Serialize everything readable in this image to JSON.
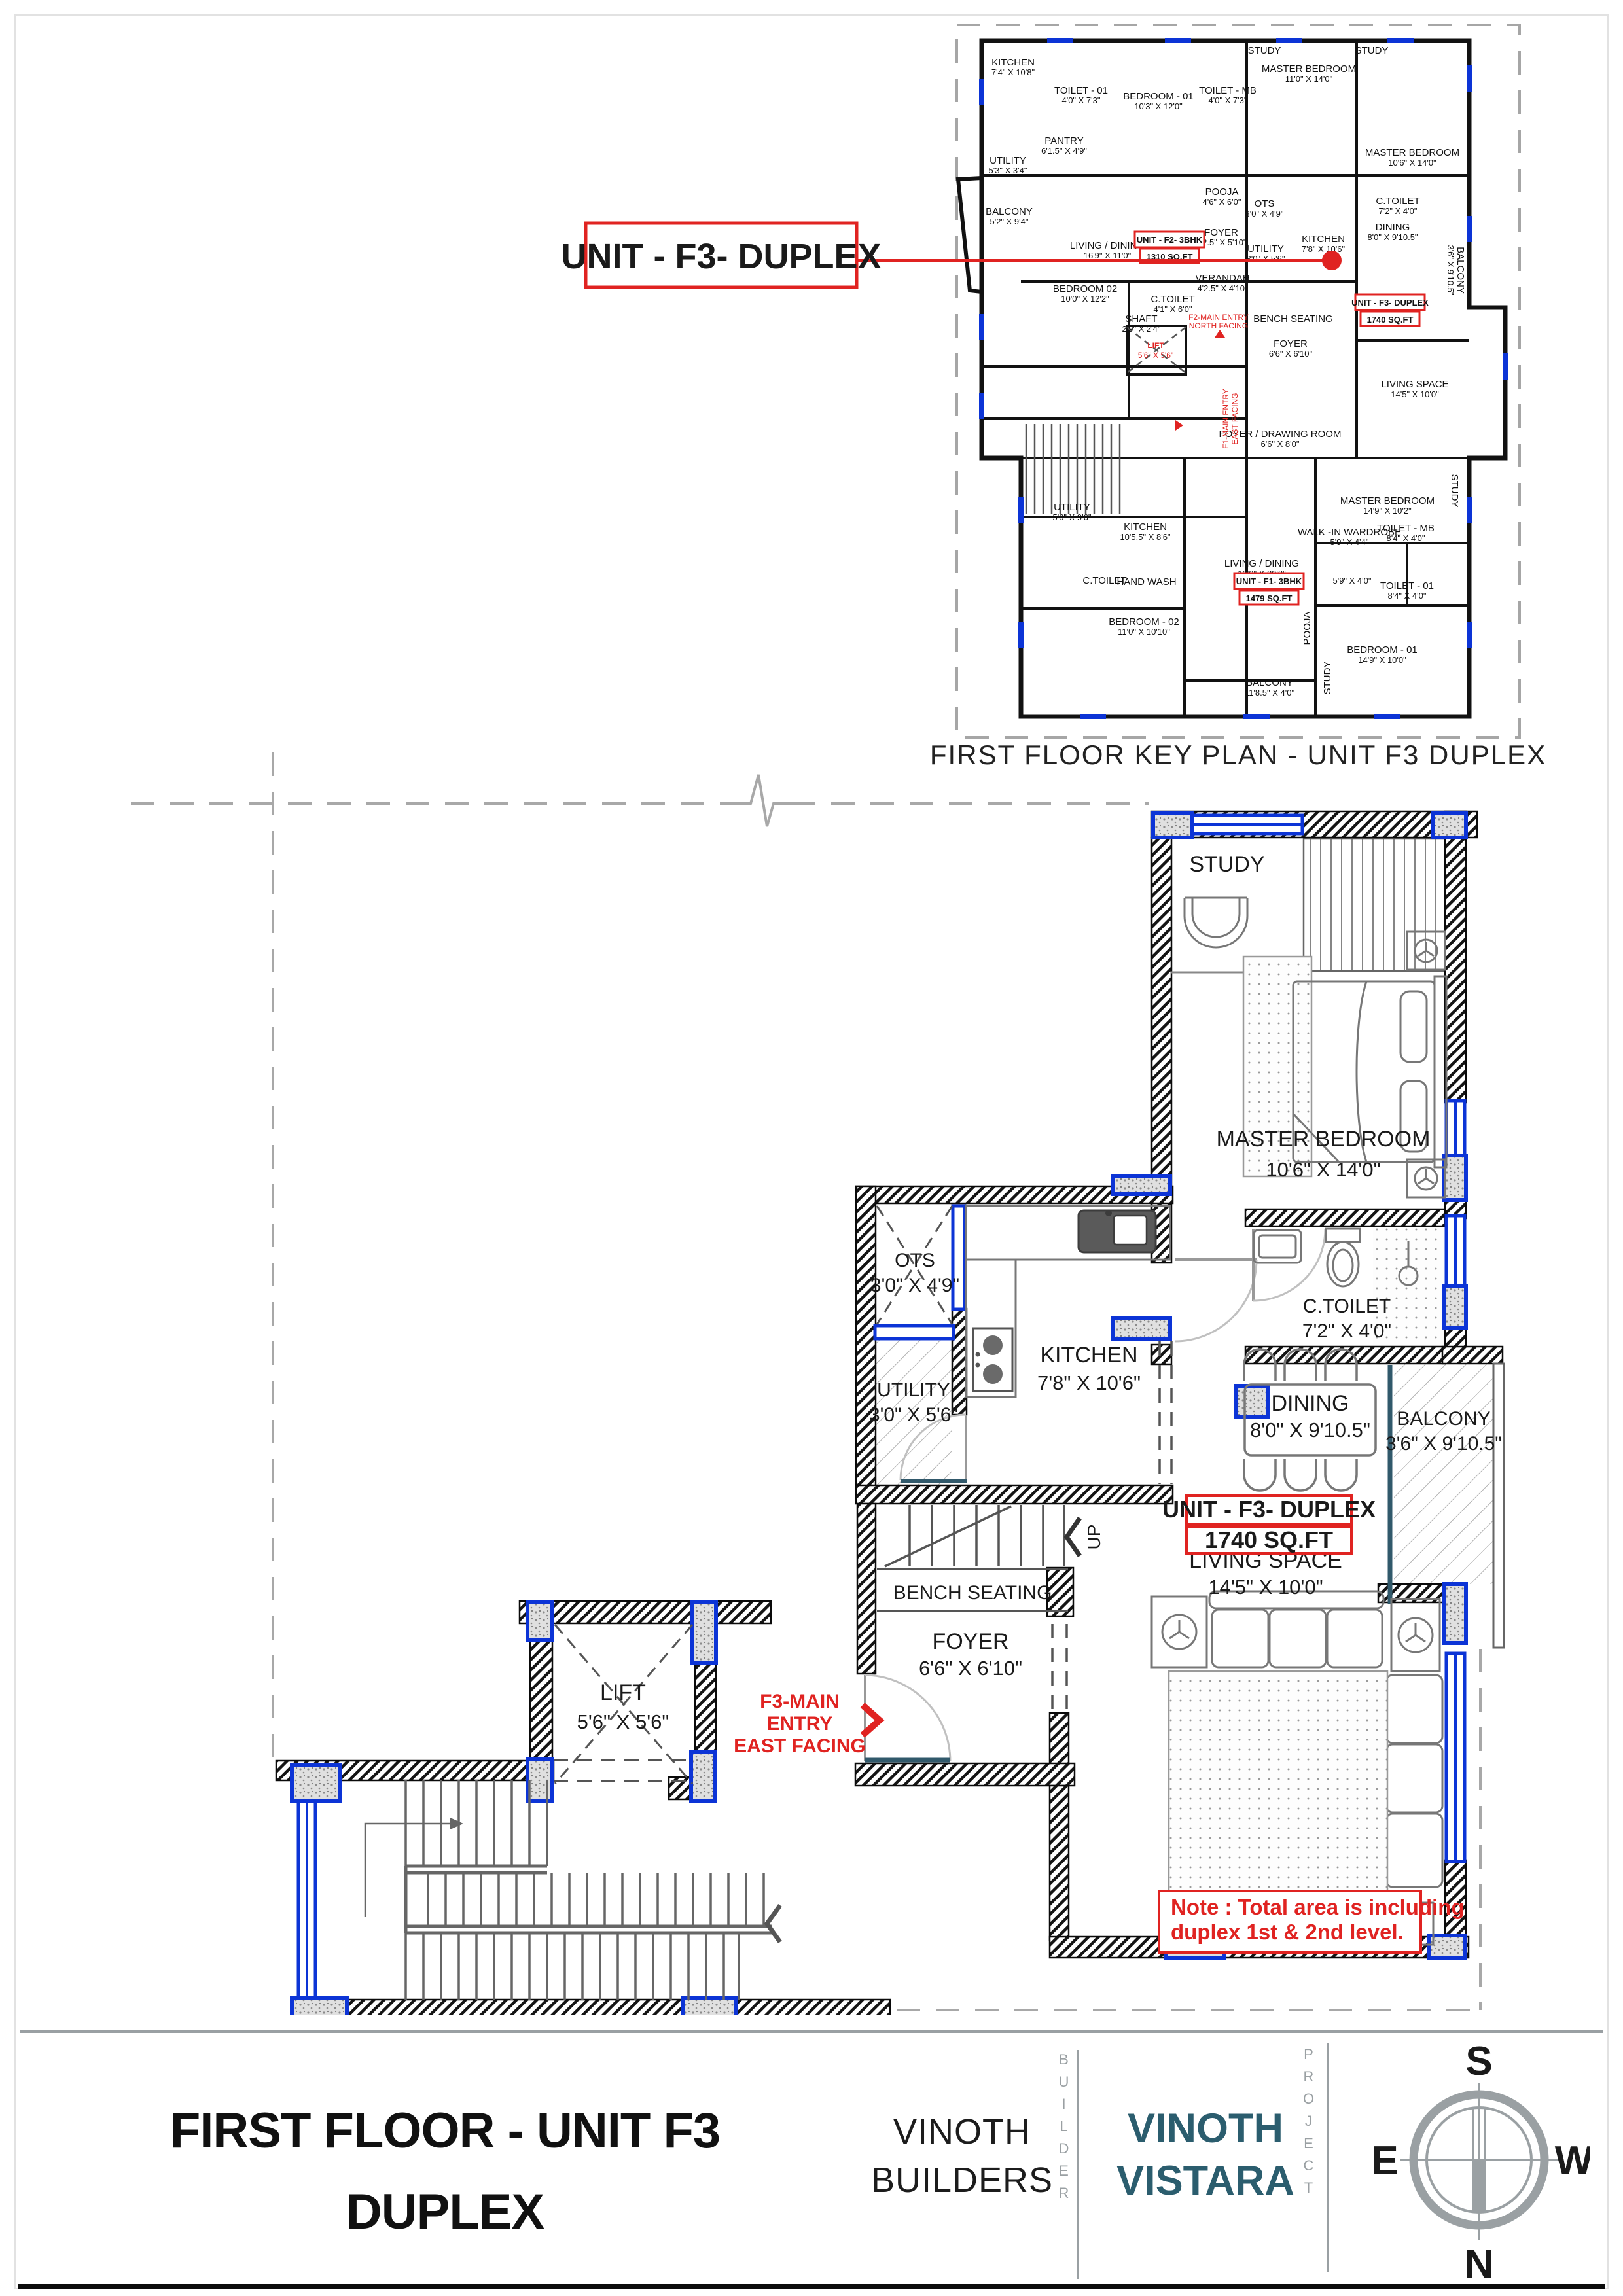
{
  "colors": {
    "accent_blue": "#0c34d6",
    "accent_red": "#e02321",
    "project_teal": "#2b5d6e",
    "compass_gray": "#9aa0a3"
  },
  "callout": {
    "label": "UNIT - F3- DUPLEX"
  },
  "key_plan": {
    "caption": "FIRST FLOOR KEY PLAN - UNIT F3 DUPLEX",
    "rooms": [
      {
        "name": "KITCHEN",
        "dims": "7'4\" X 10'8\""
      },
      {
        "name": "TOILET - 01",
        "dims": "4'0\" X 7'3\""
      },
      {
        "name": "BEDROOM - 01",
        "dims": "10'3\" X 12'0\""
      },
      {
        "name": "TOILET - MB",
        "dims": "4'0\" X 7'3\""
      },
      {
        "name": "PANTRY",
        "dims": "6'1.5\" X 4'9\""
      },
      {
        "name": "UTILITY",
        "dims": "5'3\" X 3'4\""
      },
      {
        "name": "BALCONY",
        "dims": "5'2\" X 9'4\""
      },
      {
        "name": "LIVING / DINING",
        "dims": "16'9\" X 11'0\""
      },
      {
        "name": "POOJA",
        "dims": "4'6\" X 6'0\""
      },
      {
        "name": "FOYER",
        "dims": "4'2.5\" X 5'10\""
      },
      {
        "name": "BEDROOM 02",
        "dims": "10'0\" X 12'2\""
      },
      {
        "name": "C.TOILET",
        "dims": "4'1\" X 6'0\""
      },
      {
        "name": "SHAFT",
        "dims": "2'9\" X 2'4\""
      },
      {
        "name": "VERANDAH",
        "dims": "4'2.5\" X 4'10\""
      },
      {
        "name": "STUDY",
        "dims": ""
      },
      {
        "name": "MASTER BEDROOM",
        "dims": "11'0\" X 14'0\""
      },
      {
        "name": "STUDY",
        "dims": ""
      },
      {
        "name": "MASTER BEDROOM",
        "dims": "10'6\" X 14'0\""
      },
      {
        "name": "OTS",
        "dims": "3'0\" X 4'9\""
      },
      {
        "name": "UTILITY",
        "dims": "3'0\" X 5'6\""
      },
      {
        "name": "KITCHEN",
        "dims": "7'8\" X 10'6\""
      },
      {
        "name": "C.TOILET",
        "dims": "7'2\" X 4'0\""
      },
      {
        "name": "DINING",
        "dims": "8'0\" X 9'10.5\""
      },
      {
        "name": "BENCH SEATING",
        "dims": ""
      },
      {
        "name": "FOYER",
        "dims": "6'6\" X 6'10\""
      },
      {
        "name": "BALCONY",
        "dims": "3'6\" X 9'10.5\""
      },
      {
        "name": "LIVING SPACE",
        "dims": "14'5\" X 10'0\""
      },
      {
        "name": "FOYER / DRAWING ROOM",
        "dims": "6'6\" X 8'0\""
      },
      {
        "name": "UTILITY",
        "dims": "5'0\" X 9'6\""
      },
      {
        "name": "KITCHEN",
        "dims": "10'5.5\" X 8'6\""
      },
      {
        "name": "MASTER BEDROOM",
        "dims": "14'9\" X 10'2\""
      },
      {
        "name": "STUDY",
        "dims": ""
      },
      {
        "name": "WALK -IN WARDROBE",
        "dims": "5'9\" X 4'4\""
      },
      {
        "name": "TOILET - MB",
        "dims": "8'4\" X 4'0\""
      },
      {
        "name": "TOILET - 01",
        "dims": "8'4\" X 4'0\""
      },
      {
        "name": "",
        "dims": "5'9\" X 4'0\""
      },
      {
        "name": "LIVING / DINING",
        "dims": "12'0\" X 20'0\""
      },
      {
        "name": "C.TOILET",
        "dims": ""
      },
      {
        "name": "HAND WASH",
        "dims": ""
      },
      {
        "name": "BEDROOM - 02",
        "dims": "11'0\" X 10'10\""
      },
      {
        "name": "POOJA",
        "dims": ""
      },
      {
        "name": "STUDY",
        "dims": ""
      },
      {
        "name": "BEDROOM - 01",
        "dims": "14'9\" X 10'0\""
      },
      {
        "name": "BALCONY",
        "dims": "11'8.5\" X 4'0\""
      }
    ],
    "unit_tags": {
      "f2": {
        "line1": "UNIT - F2- 3BHK",
        "line2": "1310 SQ.FT"
      },
      "f3": {
        "line1": "UNIT - F3- DUPLEX",
        "line2": "1740 SQ.FT"
      },
      "f1": {
        "line1": "UNIT - F1- 3BHK",
        "line2": "1479 SQ.FT"
      }
    },
    "entries": {
      "f2_line1": "F2-MAIN ENTRY",
      "f2_line2": "NORTH FACING",
      "f1_line1": "F1-MAIN ENTRY",
      "f1_line2": "EAST FACING"
    },
    "lift": {
      "name": "LIFT",
      "dims": "5'6\" X 5'6\""
    }
  },
  "main_plan": {
    "rooms": {
      "study": {
        "name": "STUDY"
      },
      "master": {
        "name": "MASTER BEDROOM",
        "dims": "10'6\" X 14'0\""
      },
      "ctoilet": {
        "name": "C.TOILET",
        "dims": "7'2\" X 4'0\""
      },
      "ots": {
        "name": "OTS",
        "dims": "3'0\" X 4'9\""
      },
      "kitchen": {
        "name": "KITCHEN",
        "dims": "7'8\" X 10'6\""
      },
      "utility": {
        "name": "UTILITY",
        "dims": "3'0\" X 5'6\""
      },
      "dining": {
        "name": "DINING",
        "dims": "8'0\" X 9'10.5\""
      },
      "balcony": {
        "name": "BALCONY",
        "dims": "3'6\" X 9'10.5\""
      },
      "living": {
        "name": "LIVING SPACE",
        "dims": "14'5\" X 10'0\""
      },
      "bench": {
        "name": "BENCH SEATING"
      },
      "foyer": {
        "name": "FOYER",
        "dims": "6'6\" X 6'10\""
      },
      "lift": {
        "name": "LIFT",
        "dims": "5'6\" X 5'6\""
      }
    },
    "unit_tag": {
      "line1": "UNIT - F3- DUPLEX",
      "line2": "1740 SQ.FT"
    },
    "entry": {
      "line1": "F3-MAIN",
      "line2": "ENTRY",
      "line3": "EAST FACING"
    },
    "stairs_up": "UP",
    "note": {
      "line1": "Note : Total area is including",
      "line2": "duplex 1st & 2nd level."
    }
  },
  "title_block": {
    "title_line1": "FIRST FLOOR - UNIT F3",
    "title_line2": "DUPLEX",
    "builder_line1": "VINOTH",
    "builder_line2": "BUILDERS",
    "builder_role": "BUILDER",
    "project_line1": "VINOTH",
    "project_line2": "VISTARA",
    "project_role": "PROJECT",
    "compass": {
      "top": "S",
      "bottom": "N",
      "left": "E",
      "right": "W"
    }
  }
}
